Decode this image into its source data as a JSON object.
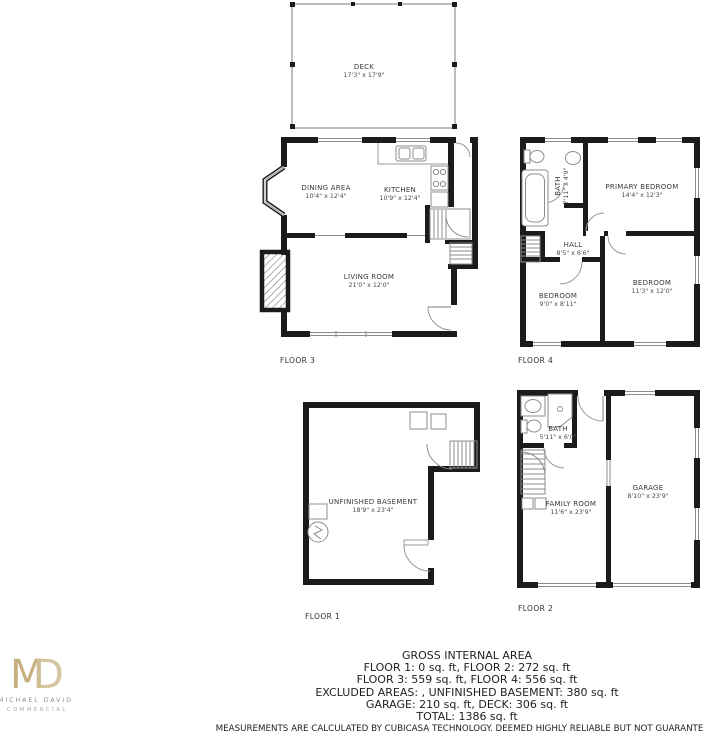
{
  "colors": {
    "wall": "#1b1b1b",
    "thin_line": "#8c8c8c",
    "logo_gold": "#c6b07f"
  },
  "branding": {
    "logo_m": "M",
    "logo_d": "D",
    "company": "MICHAEL DAVID",
    "division": "COMMERCIAL"
  },
  "floors": {
    "deck": {
      "rooms": {
        "deck": {
          "name": "DECK",
          "dims": "17'3\" x 17'9\""
        }
      }
    },
    "floor3": {
      "label": "FLOOR 3",
      "rooms": {
        "dining": {
          "name": "DINING AREA",
          "dims": "10'4\" x 12'4\""
        },
        "kitchen": {
          "name": "KITCHEN",
          "dims": "10'9\" x 12'4\""
        },
        "living": {
          "name": "LIVING ROOM",
          "dims": "21'0\" x 12'0\""
        }
      }
    },
    "floor4": {
      "label": "FLOOR 4",
      "rooms": {
        "bath": {
          "name": "BATH",
          "dims": "7'11\" x 4'9\""
        },
        "primary": {
          "name": "PRIMARY BEDROOM",
          "dims": "14'4\" x 12'3\""
        },
        "hall": {
          "name": "HALL",
          "dims": "8'5\" x 6'6\""
        },
        "bedroom_small": {
          "name": "BEDROOM",
          "dims": "9'0\" x 8'11\""
        },
        "bedroom_large": {
          "name": "BEDROOM",
          "dims": "11'3\" x 12'0\""
        }
      }
    },
    "floor1": {
      "label": "FLOOR 1",
      "rooms": {
        "basement": {
          "name": "UNFINISHED BASEMENT",
          "dims": "18'9\" x 23'4\""
        }
      }
    },
    "floor2": {
      "label": "FLOOR 2",
      "rooms": {
        "bath": {
          "name": "BATH",
          "dims": "5'11\" x 6'0\""
        },
        "family": {
          "name": "FAMILY ROOM",
          "dims": "11'6\" x 23'9\""
        },
        "garage": {
          "name": "GARAGE",
          "dims": "8'10\" x 23'9\""
        }
      }
    }
  },
  "summary": {
    "title": "GROSS INTERNAL AREA",
    "lines": [
      "FLOOR 1: 0 sq. ft, FLOOR 2: 272 sq. ft",
      "FLOOR 3: 559 sq. ft, FLOOR 4: 556 sq. ft",
      "EXCLUDED AREAS: , UNFINISHED BASEMENT: 380 sq. ft",
      "GARAGE: 210 sq. ft, DECK: 306 sq. ft",
      "TOTAL: 1386 sq. ft"
    ],
    "disclaimer": "MEASUREMENTS ARE CALCULATED BY CUBICASA TECHNOLOGY. DEEMED HIGHLY RELIABLE BUT NOT GUARANTEED."
  }
}
